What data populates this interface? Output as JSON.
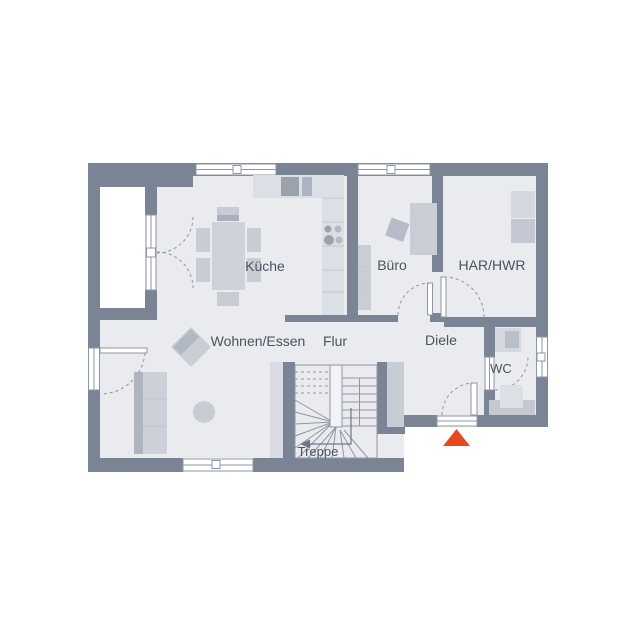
{
  "labels": {
    "kueche": "Küche",
    "buero": "Büro",
    "har": "HAR/HWR",
    "wohnen": "Wohnen/Essen",
    "flur": "Flur",
    "diele": "Diele",
    "wc": "WC",
    "treppe": "Treppe"
  },
  "colors": {
    "wall": "#7b8495",
    "floor": "#e9ebef",
    "outside": "#ffffff",
    "line": "#8d96a4",
    "furn": "#c7ccd5",
    "furn-light": "#d9dce3",
    "furn-dark": "#9ba2ae",
    "label": "#4a5362",
    "accent": "#e8481d"
  },
  "markers": {
    "entrance": "triangle-up"
  }
}
